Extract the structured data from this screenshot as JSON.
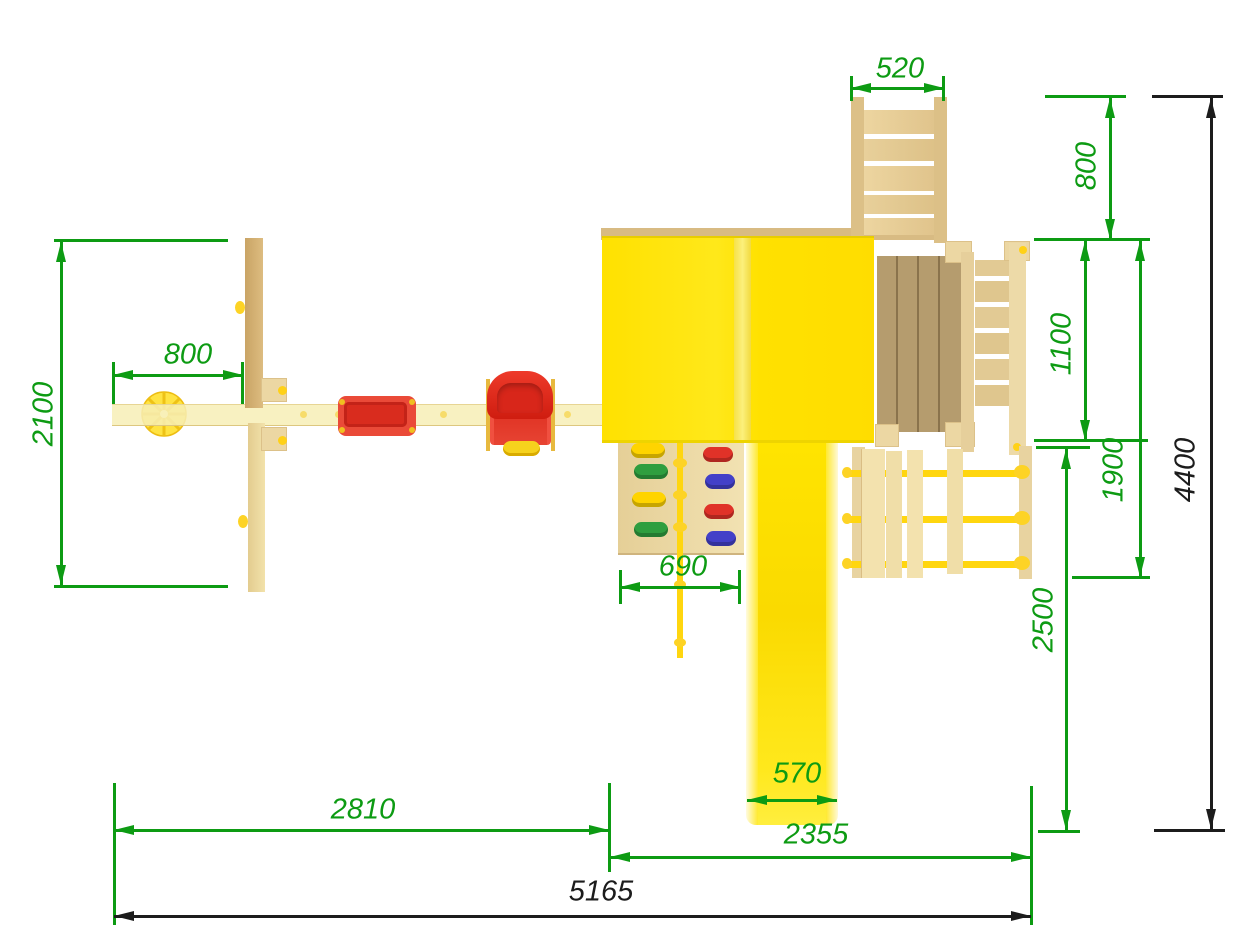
{
  "drawing": {
    "type": "playground-top-view-dimension-plan",
    "units": "mm"
  },
  "dims": {
    "ladder_width": "520",
    "ladder_depth": "800",
    "swing_offset": "800",
    "swing_depth": "2100",
    "platform_depth": "1100",
    "platform_total_depth": "1900",
    "bridge_depth": "2500",
    "total_depth": "4400",
    "wall_width": "690",
    "slide_width": "570",
    "swing_section_width": "2810",
    "tower_section_width": "2355",
    "total_width": "5165"
  },
  "colors": {
    "dimension_green": "#0d9b13",
    "dimension_black": "#1c1c1c",
    "roof_yellow": "#ffe506",
    "slide_yellow": "#ffdf00",
    "rope_yellow": "#ffd60f",
    "wood_light": "#f5ecae",
    "wood_mid": "#e2c88e",
    "wood_dark": "#b59c6e",
    "plastic_red": "#e5392c",
    "hold_green": "#2f9e3f",
    "hold_blue": "#4340c8"
  }
}
